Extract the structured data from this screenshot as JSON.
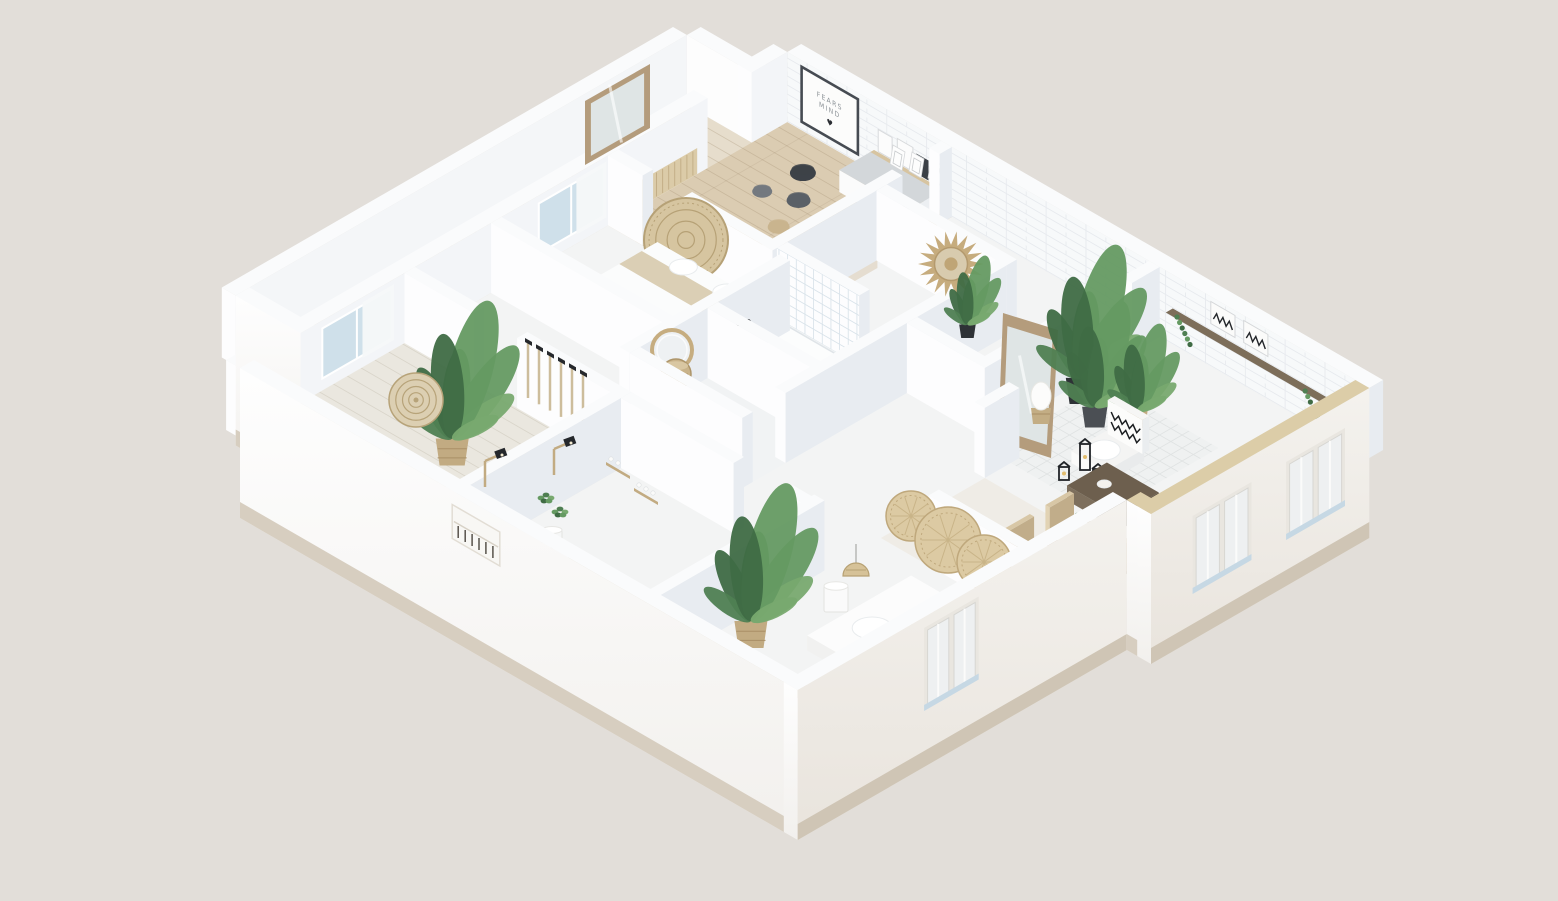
{
  "meta": {
    "type": "isometric-floor-plan-render",
    "description": "3D isometric cutaway rendering of a furnished apartment with white walls, plants and rattan decor",
    "background": "#e2ded9"
  },
  "poster": {
    "line1": "FEARS",
    "line2": "MIND",
    "heart": "♥"
  },
  "palette": {
    "bg": "#e2ded9",
    "slab": "#f3f4f4",
    "wall_top": "#fafbfc",
    "face_sw": "#fdfdfe",
    "face_se": "#e8ecf1",
    "inner_se": "#f3f5f8",
    "glass": "#cfe0ea",
    "curtain": "#f6f8f9",
    "plinth": "#d7cec0",
    "plinth_se": "#cfc5b5",
    "coping": "#dccda8",
    "wood_floor": "#dbccb2",
    "wood_floor_light": "#e6ddcc",
    "pale_floor": "#eae7df",
    "counter_top": "#d8cfba",
    "rattan": "#d6c5a0",
    "rattan_line": "#b6a176",
    "wood_mid": "#b79e7e",
    "wood_dark": "#6d5f4e",
    "green_1": "#4f7f52",
    "green_2": "#659a62",
    "green_3": "#3f6b44",
    "green_4": "#78a96f",
    "dark": "#34383e",
    "pot_black": "#2e3236",
    "pot_basket": "#c2ab82",
    "white": "#ffffff"
  },
  "scene": {
    "proj": {
      "ox": 240,
      "oy": 438,
      "cos": 0.866,
      "sin": 0.5,
      "wall_h": 70,
      "base_depth": 80
    },
    "outline": [
      [
        0,
        0
      ],
      [
        0,
        70
      ],
      [
        -75,
        70
      ],
      [
        -75,
        591
      ],
      [
        0,
        591
      ],
      [
        0,
        632
      ],
      [
        672,
        632
      ],
      [
        672,
        380
      ],
      [
        644,
        380
      ],
      [
        644,
        0
      ]
    ],
    "floors": [
      {
        "t": "slabO",
        "n": "floor-slab"
      },
      {
        "t": "flat",
        "u1": -75,
        "u2": 0,
        "v1": 70,
        "v2": 591,
        "f": "#e6ddcc",
        "pat": "pplank",
        "n": "wing-wood-floor"
      },
      {
        "t": "flat",
        "u1": 0,
        "u2": 190,
        "v1": 425,
        "v2": 632,
        "f": "#dbccb2",
        "pat": "pplank",
        "n": "poster-room-wood-floor"
      },
      {
        "t": "flat",
        "u1": 0,
        "u2": 250,
        "v1": 0,
        "v2": 190,
        "f": "#eae7df",
        "pat": "pplank2",
        "n": "left-room-floor"
      },
      {
        "t": "flat",
        "u1": 210,
        "u2": 340,
        "v1": 240,
        "v2": 430,
        "f": "#f1f3f4",
        "n": "bathroom-floor"
      },
      {
        "t": "flat",
        "u1": 470,
        "u2": 672,
        "v1": 270,
        "v2": 390,
        "f": "#efece6",
        "n": "dining-floor"
      },
      {
        "t": "flat",
        "u1": 445,
        "u2": 575,
        "v1": 420,
        "v2": 555,
        "f": "#eff1f1",
        "pat": "prug",
        "n": "living-rug"
      }
    ],
    "back": [
      {
        "t": "wv",
        "u": -75,
        "v1": 70,
        "v2": 591,
        "tk": 16,
        "f": "#f4f6f8",
        "n": "wing-outer-wall"
      },
      {
        "t": "wu",
        "v": 591,
        "u1": -75,
        "u2": 0,
        "tk": 16,
        "f": "#fdfdfd",
        "n": "wing-end-wall"
      },
      {
        "t": "wv",
        "u": 0,
        "v1": 0,
        "v2": 540,
        "tk": 16,
        "f": "#f3f5f8",
        "n": "nw-wall"
      },
      {
        "t": "wv",
        "u": 0,
        "v1": 591,
        "v2": 632,
        "tk": 16,
        "f": "#f3f5f8",
        "n": "nw-wall-2"
      },
      {
        "t": "wu",
        "v": 632,
        "u1": 0,
        "u2": 672,
        "tk": 16,
        "f": "#f7f9fa",
        "pat": "pbrick",
        "n": "ne-wall-brick"
      },
      {
        "t": "win",
        "u": 0,
        "a1": 95,
        "a2": 175,
        "z1": 12,
        "z2": 62,
        "n": "window-left-room"
      },
      {
        "t": "win",
        "u": 0,
        "a1": 345,
        "a2": 420,
        "z1": 12,
        "z2": 62,
        "n": "window-bedroom"
      },
      {
        "t": "slatW",
        "v1": 440,
        "v2": 528,
        "z2": 26,
        "n": "slat-bench"
      },
      {
        "t": "poster",
        "u1": 16,
        "u2": 84,
        "z1": 8,
        "z2": 66,
        "n": "wall-poster"
      },
      {
        "t": "shelfA",
        "n": "desk-shelf"
      },
      {
        "t": "shelfL",
        "n": "living-shelf"
      }
    ],
    "items": [
      {
        "t": "mirT",
        "pts": [
          [
            650,
            64
          ],
          [
            585,
            101
          ],
          [
            585,
            165
          ],
          [
            650,
            128
          ]
        ],
        "n": "wing-mirror"
      },
      {
        "t": "box",
        "u": 100,
        "v": 592,
        "du": 80,
        "dv": 36,
        "z": 0,
        "h": 22,
        "ct": "#d3d7da",
        "cs": "#fbfbfb",
        "ce": "#eceff2",
        "n": "desk"
      },
      {
        "t": "frames",
        "x": 890,
        "y": 164,
        "n": "leaning-frames"
      },
      {
        "t": "pouf",
        "u": 60,
        "v": 590,
        "r": 13,
        "c": "#3d4248",
        "n": "pouf"
      },
      {
        "t": "pouf",
        "u": 85,
        "v": 560,
        "r": 12,
        "c": "#5a6067",
        "n": "pouf"
      },
      {
        "t": "pouf",
        "u": 55,
        "v": 548,
        "r": 10,
        "c": "#74797f",
        "n": "pouf"
      },
      {
        "t": "pouf",
        "u": 100,
        "v": 522,
        "r": 11,
        "c": "#c9b48e",
        "n": "pouf"
      },
      {
        "t": "box",
        "u": 140,
        "v": 482,
        "du": 58,
        "dv": 56,
        "z": 0,
        "h": 10,
        "ct": "#c0a886",
        "cs": "#f5f1ea",
        "ce": "#e5ddd0",
        "n": "low-table"
      },
      {
        "t": "dots",
        "x": 824,
        "y": 258,
        "n": "fruit-bowl"
      },
      {
        "t": "wu",
        "v": 425,
        "u1": 0,
        "u2": 40,
        "n": "poster-room-wall"
      },
      {
        "t": "wu",
        "v": 425,
        "u1": 85,
        "u2": 190,
        "n": "poster-room-wall"
      },
      {
        "t": "disc",
        "x": 686,
        "y": 240,
        "r": 42,
        "n": "rattan-headboard"
      },
      {
        "t": "wv",
        "u": 190,
        "v1": 425,
        "v2": 575,
        "n": "poster-room-side-wall"
      },
      {
        "t": "wv",
        "u": 190,
        "v1": 618,
        "v2": 632,
        "n": "poster-room-side-wall"
      },
      {
        "t": "wu",
        "v": 545,
        "u1": 190,
        "u2": 340,
        "n": "hall-wall"
      },
      {
        "t": "wv",
        "u": 340,
        "v1": 430,
        "v2": 545,
        "n": "hall-wall-2"
      },
      {
        "t": "sun",
        "x": 951,
        "y": 264,
        "r": 33,
        "n": "sunburst-mirror"
      },
      {
        "t": "plant",
        "u": 320,
        "v": 520,
        "s": 0.75,
        "pot": "black",
        "n": "hall-plant"
      },
      {
        "t": "box",
        "u": 60,
        "v": 348,
        "du": 135,
        "dv": 74,
        "z": 0,
        "h": 15,
        "ct": "#fbfcfc",
        "cs": "#f2f2f1",
        "ce": "#e8eaec",
        "n": "bed"
      },
      {
        "t": "fquad",
        "u1": 60,
        "u2": 195,
        "v1": 378,
        "v2": 404,
        "z": 15,
        "f": "#dbcfb5",
        "n": "bed-throw"
      },
      {
        "t": "puff",
        "u": 100,
        "v": 412,
        "z": 15,
        "rx": 14,
        "ry": 8,
        "c": "#ffffff",
        "n": "pillow"
      },
      {
        "t": "puff",
        "u": 150,
        "v": 412,
        "z": 15,
        "rx": 14,
        "ry": 8,
        "c": "#ffffff",
        "n": "pillow"
      },
      {
        "t": "wu",
        "v": 290,
        "u1": 0,
        "u2": 210,
        "n": "bedroom-wall"
      },
      {
        "t": "wu",
        "v": 430,
        "u1": 190,
        "u2": 285,
        "pat": "ptile",
        "n": "shower-wall"
      },
      {
        "t": "wu",
        "v": 430,
        "u1": 340,
        "u2": 430,
        "n": "bath-wall"
      },
      {
        "t": "fquad",
        "u1": 196,
        "u2": 276,
        "v1": 388,
        "v2": 426,
        "z": 2,
        "f": "#fcfdfd",
        "st": "#dfe4e8",
        "n": "shower-tray"
      },
      {
        "t": "wv",
        "u": 210,
        "v1": 240,
        "v2": 425,
        "n": "bath-wall-w"
      },
      {
        "t": "fix",
        "x": 742,
        "y": 330,
        "n": "shower-fixture"
      },
      {
        "t": "mirR",
        "x": 672,
        "y": 350,
        "r": 20,
        "n": "round-mirror"
      },
      {
        "t": "toilet",
        "u": 243,
        "v": 362,
        "n": "toilet"
      },
      {
        "t": "bask",
        "x": 676,
        "y": 374,
        "r": 15,
        "n": "laundry-basket"
      },
      {
        "t": "wu",
        "v": 330,
        "u1": 210,
        "u2": 340,
        "n": "bath-divider"
      },
      {
        "t": "wu",
        "v": 240,
        "u1": 210,
        "u2": 340,
        "n": "bath-wall-s"
      },
      {
        "t": "wv",
        "u": 340,
        "v1": 290,
        "v2": 430,
        "n": "bath-wall-e"
      },
      {
        "t": "wu",
        "v": 190,
        "u1": 0,
        "u2": 80,
        "n": "left-room-wall"
      },
      {
        "t": "wu",
        "v": 190,
        "u1": 130,
        "u2": 250,
        "n": "left-room-wall"
      },
      {
        "t": "hooks",
        "x": 528,
        "y": 340,
        "n": "coat-hooks"
      },
      {
        "t": "plant",
        "u": 150,
        "v": 95,
        "s": 1.5,
        "pot": "bask",
        "n": "plant-left-room"
      },
      {
        "t": "spiral",
        "x": 416,
        "y": 400,
        "r": 27,
        "n": "rattan-spiral"
      },
      {
        "t": "wv",
        "u": 250,
        "v1": 0,
        "v2": 190,
        "n": "kitchen-wall-w"
      },
      {
        "t": "shelfB",
        "x": 606,
        "y": 462,
        "n": "kitchen-shelf"
      },
      {
        "t": "shelfB",
        "x": 634,
        "y": 488,
        "n": "kitchen-shelf"
      },
      {
        "t": "wu",
        "v": 190,
        "u1": 250,
        "u2": 380,
        "n": "kitchen-wall-n"
      },
      {
        "t": "wu",
        "v": 190,
        "u1": 435,
        "u2": 470,
        "n": "kitchen-wall-n"
      },
      {
        "t": "lampA",
        "x": 497,
        "y": 459,
        "n": "wall-lamp"
      },
      {
        "t": "lampA",
        "x": 566,
        "y": 447,
        "n": "wall-lamp"
      },
      {
        "t": "tuft",
        "x": 546,
        "y": 500,
        "n": "kitchen-plant"
      },
      {
        "t": "tuft",
        "x": 560,
        "y": 514,
        "n": "kitchen-plant"
      },
      {
        "t": "drum",
        "x": 552,
        "y": 548,
        "r": 10,
        "h": 18,
        "c": "#f6f7f7",
        "n": "bin"
      },
      {
        "t": "wv",
        "u": 430,
        "v1": 430,
        "v2": 545,
        "n": "living-wall-w"
      },
      {
        "t": "wv",
        "u": 430,
        "v1": 600,
        "v2": 632,
        "n": "living-wall-w"
      },
      {
        "t": "mirT",
        "pts": [
          [
            1003,
            313
          ],
          [
            1058,
            330
          ],
          [
            1051,
            458
          ],
          [
            998,
            441
          ]
        ],
        "n": "leaning-mirror"
      },
      {
        "t": "plant",
        "u": 452,
        "v": 520,
        "s": 1.45,
        "pot": "black",
        "n": "plant-living"
      },
      {
        "t": "plant",
        "u": 483,
        "v": 504,
        "s": 1.15,
        "pot": "dark",
        "n": "plant-living"
      },
      {
        "t": "plant",
        "u": 508,
        "v": 528,
        "s": 0.95,
        "pot": "bask",
        "n": "plant-living"
      },
      {
        "t": "egg",
        "x": 1041,
        "y": 424,
        "n": "egg-lamp"
      },
      {
        "t": "armch",
        "u": 505,
        "v": 455,
        "n": "armchair"
      },
      {
        "t": "lant",
        "x": 1085,
        "y": 470,
        "h": 26,
        "n": "lantern"
      },
      {
        "t": "lant",
        "x": 1098,
        "y": 486,
        "h": 17,
        "n": "lantern"
      },
      {
        "t": "lant",
        "x": 1064,
        "y": 480,
        "h": 13,
        "n": "lantern"
      },
      {
        "t": "box",
        "u": 540,
        "v": 415,
        "du": 60,
        "dv": 46,
        "z": 0,
        "h": 15,
        "ct": "#6d5f4e",
        "cs": "#7d6f5d",
        "ce": "#5d5142",
        "n": "coffee-table"
      },
      {
        "t": "puff",
        "u": 560,
        "v": 438,
        "z": 15,
        "rx": 7,
        "ry": 4,
        "c": "#f4f2ee",
        "n": "table-decor"
      },
      {
        "t": "box",
        "u": 590,
        "v": 308,
        "du": 58,
        "dv": 74,
        "z": 0,
        "h": 26,
        "ct": "#b79e7e",
        "cs": "#c7b193",
        "ce": "#a08a6b",
        "n": "dining-table"
      },
      {
        "t": "tuft",
        "x": 1078,
        "y": 520,
        "n": "centerpiece"
      },
      {
        "t": "chairD",
        "u": 575,
        "v": 314,
        "side": "nw",
        "n": "dining-chair"
      },
      {
        "t": "chairD",
        "u": 575,
        "v": 360,
        "side": "nw",
        "n": "dining-chair"
      },
      {
        "t": "chairD",
        "u": 650,
        "v": 314,
        "side": "se",
        "n": "dining-chair"
      },
      {
        "t": "chairD",
        "u": 650,
        "v": 360,
        "side": "se",
        "n": "dining-chair"
      },
      {
        "t": "wv",
        "u": 470,
        "v1": 390,
        "v2": 430,
        "n": "hall-wall-3"
      },
      {
        "t": "wu",
        "v": 270,
        "u1": 525,
        "u2": 644,
        "n": "bedroom2-wall"
      },
      {
        "t": "fan",
        "x": 911,
        "y": 516,
        "r": 25,
        "n": "rattan-fan"
      },
      {
        "t": "fan",
        "x": 948,
        "y": 540,
        "r": 33,
        "n": "rattan-fan"
      },
      {
        "t": "fan",
        "x": 984,
        "y": 562,
        "r": 27,
        "n": "rattan-fan"
      },
      {
        "t": "wv",
        "u": 470,
        "v1": 0,
        "v2": 205,
        "n": "bedroom2-wall-w"
      },
      {
        "t": "box",
        "u": 540,
        "v": 115,
        "du": 86,
        "dv": 120,
        "z": 0,
        "h": 15,
        "ct": "#fcfcfc",
        "cs": "#f1f1f0",
        "ce": "#e9ebed",
        "n": "bed2"
      },
      {
        "t": "puff",
        "u": 570,
        "v": 160,
        "z": 15,
        "rx": 20,
        "ry": 11,
        "c": "#ffffff",
        "n": "duvet"
      },
      {
        "t": "puff",
        "u": 595,
        "v": 200,
        "z": 15,
        "rx": 18,
        "ry": 10,
        "c": "#ffffff",
        "n": "duvet"
      },
      {
        "t": "puff",
        "u": 612,
        "v": 140,
        "z": 17,
        "rx": 11,
        "ry": 6,
        "c": "#fdfdfd",
        "n": "pillow"
      },
      {
        "t": "puff",
        "u": 612,
        "v": 185,
        "z": 17,
        "rx": 11,
        "ry": 6,
        "c": "#fdfdfd",
        "n": "pillow"
      },
      {
        "t": "box",
        "u": 626,
        "v": 108,
        "du": 16,
        "dv": 134,
        "z": 0,
        "h": 30,
        "ct": "#e5d5b2",
        "cs": "#dcc8a2",
        "ce": "#cdb78f",
        "n": "slat-headboard"
      },
      {
        "t": "plant",
        "u": 505,
        "v": 85,
        "s": 1.5,
        "pot": "bask",
        "n": "plant-bedroom2"
      },
      {
        "t": "drum",
        "x": 836,
        "y": 612,
        "r": 12,
        "h": 26,
        "c": "#fafafa",
        "n": "drum-lamp"
      },
      {
        "t": "pend",
        "x": 856,
        "y": 588,
        "n": "rattan-pendant"
      },
      {
        "t": "wu",
        "v": 36,
        "u1": 335,
        "u2": 640,
        "tk": 18,
        "h": 26,
        "top": "#d8cfba",
        "f": "#fbfbfa",
        "n": "counter"
      }
    ],
    "front": [
      {
        "t": "owu",
        "v": 70,
        "u1": -75,
        "u2": 0,
        "n": "wing-front-wall"
      },
      {
        "t": "owu",
        "v": 0,
        "u1": 0,
        "u2": 644,
        "n": "sw-outer-wall"
      },
      {
        "t": "nic",
        "u1": 245,
        "u2": 300,
        "z1": 22,
        "z2": 56,
        "n": "wall-niche"
      },
      {
        "t": "owv",
        "u": 644,
        "v1": 0,
        "v2": 380,
        "n": "se-outer-wall"
      },
      {
        "t": "winO",
        "u": 644,
        "a1": 150,
        "a2": 205,
        "z1": -20,
        "z2": 55,
        "n": "window"
      },
      {
        "t": "owu",
        "v": 380,
        "u1": 644,
        "u2": 672,
        "cop": 1,
        "n": "se-step-wall"
      },
      {
        "t": "owv",
        "u": 672,
        "v1": 380,
        "v2": 632,
        "cop": 1,
        "n": "se-outer-wall-2"
      },
      {
        "t": "winO",
        "u": 672,
        "a1": 432,
        "a2": 492,
        "z1": -30,
        "z2": 40,
        "n": "window"
      },
      {
        "t": "winO",
        "u": 672,
        "a1": 540,
        "a2": 600,
        "z1": -30,
        "z2": 40,
        "n": "window"
      }
    ]
  }
}
